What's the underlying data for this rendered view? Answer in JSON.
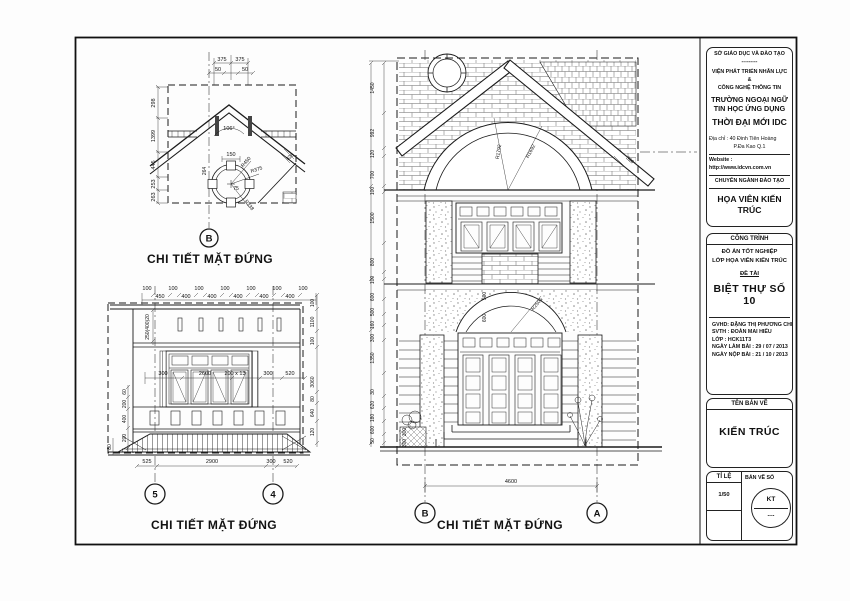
{
  "title_block": {
    "org": {
      "l1": "SỞ GIÁO DỤC VÀ ĐÀO TẠO",
      "sep": "---------",
      "l2": "VIỆN PHÁT TRIỂN NHÂN LỰC",
      "l3": "&",
      "l4": "CÔNG NGHỆ THÔNG TIN",
      "l5": "TRƯỜNG NGOẠI NGỮ",
      "l6": "TIN HỌC ỨNG DỤNG",
      "l7": "THỜI ĐẠI MỚI IDC",
      "addr1": "Địa chỉ   : 40 Đinh Tiên Hoàng",
      "addr2": "P.Đa Kao      Q.1",
      "web": "Website : http://www.idcvn.com.vn",
      "dept_label": "CHUYÊN NGÀNH ĐÀO TẠO",
      "dept": "HỌA VIÊN KIẾN TRÚC"
    },
    "project": {
      "header": "CÔNG TRÌNH",
      "l1": "ĐỒ ÁN TỐT NGHIỆP",
      "l2": "LỚP HỌA VIÊN KIẾN TRÚC",
      "topic_label": "ĐỀ TÀI",
      "topic": "BIỆT THỰ SỐ 10",
      "gvhd": "GVHD: ĐẶNG THỊ PHƯƠNG CHI",
      "svth": "SVTH :  ĐOÀN MAI HIẾU",
      "lop": "LỚP    :  HCK11T3",
      "d1": "NGÀY LÀM BÀI      : 29 / 07 / 2013",
      "d2": "NGÀY NỘP BÀI      : 21 / 10 / 2013"
    },
    "sheet_name": {
      "label": "TÊN BẢN VẼ",
      "value": "KIẾN TRÚC"
    },
    "scale": {
      "label": "TỈ LỆ",
      "value": "1/50"
    },
    "number": {
      "label": "BẢN VẼ SỐ",
      "code": "KT",
      "dots": "...."
    }
  },
  "detail_b": {
    "bubble": "B",
    "title": "CHI TIẾT MẶT ĐỨNG",
    "top": [
      "375",
      "375"
    ],
    "top2": [
      "50",
      "50"
    ],
    "left": [
      "298",
      "1399",
      "445",
      "253",
      "263"
    ],
    "angle": "106°",
    "d150": "150",
    "d75": "75",
    "d264": "264",
    "radii": [
      "R450",
      "R375",
      "R338"
    ],
    "diag": "328"
  },
  "detail_54": {
    "bubbles": [
      "5",
      "4"
    ],
    "title": "CHI TIẾT MẶT ĐỨNG",
    "top100": [
      "100",
      "100",
      "100",
      "100",
      "100",
      "100",
      "100"
    ],
    "top400": [
      "450",
      "400",
      "400",
      "400",
      "400",
      "400"
    ],
    "left_rot": "250(400)20",
    "mid": [
      "300",
      "2600",
      "200 x 13",
      "300",
      "520"
    ],
    "left": [
      "60",
      "200",
      "400",
      "200",
      "80"
    ],
    "right": [
      "100",
      "1100",
      "100",
      "3060",
      "80",
      "640",
      "120"
    ],
    "bottom": [
      "525",
      "2900",
      "300",
      "520"
    ]
  },
  "main": {
    "bubbles": [
      "B",
      "A"
    ],
    "title": "CHI TIẾT MẶT ĐỨNG",
    "left": [
      "1450",
      "992",
      "120",
      "700",
      "100",
      "1500",
      "800",
      "100",
      "600",
      "500",
      "160",
      "300",
      "1350",
      "30",
      "620",
      "180",
      "600",
      "50"
    ],
    "radii_upper": [
      "R1792",
      "R1692"
    ],
    "radius_lower": "R2501",
    "arch": [
      "500",
      "600"
    ],
    "steps": [
      "300",
      "300"
    ],
    "bottom": "4600",
    "diag": "320"
  }
}
